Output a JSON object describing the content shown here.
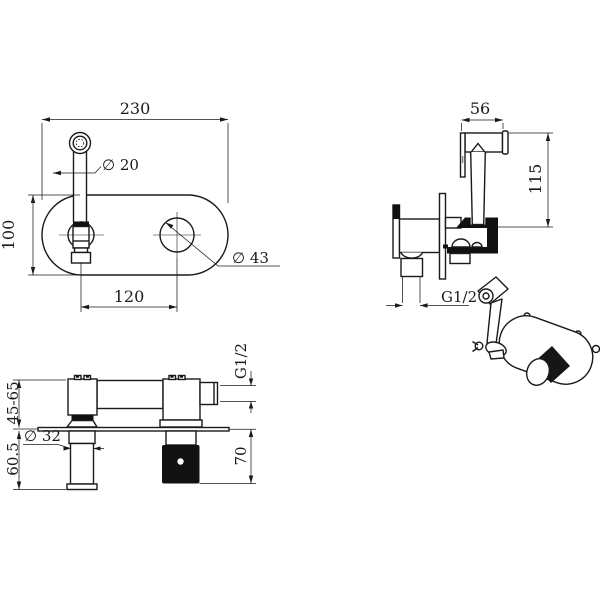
{
  "meta": {
    "drawing_type": "technical-dimension-drawing",
    "subject": "concealed wall-mounted bidet sprayer / spout set",
    "background": "#ffffff",
    "line_color": "#1a1a1a",
    "section_fill": "#111111"
  },
  "views": {
    "front": {
      "label": "front-view-of-oval-plate",
      "dims": {
        "width": "230",
        "height": "100",
        "spout_tube_diameter": "∅ 20",
        "handle_hole_diameter": "∅ 43",
        "hole_spacing": "120"
      }
    },
    "side": {
      "label": "side-view-sprayer-and-valve",
      "dims": {
        "head_length": "56",
        "overall_height": "115",
        "inlet_thread": "G1/2"
      }
    },
    "install": {
      "label": "installation-section-view",
      "dims": {
        "wall_depth_range": "45-65",
        "spout_projection": "60.5",
        "spout_diameter": "∅ 32",
        "handle_projection": "70",
        "outlet_thread": "G1/2"
      }
    },
    "perspective": {
      "label": "perspective-view-assembled"
    }
  }
}
